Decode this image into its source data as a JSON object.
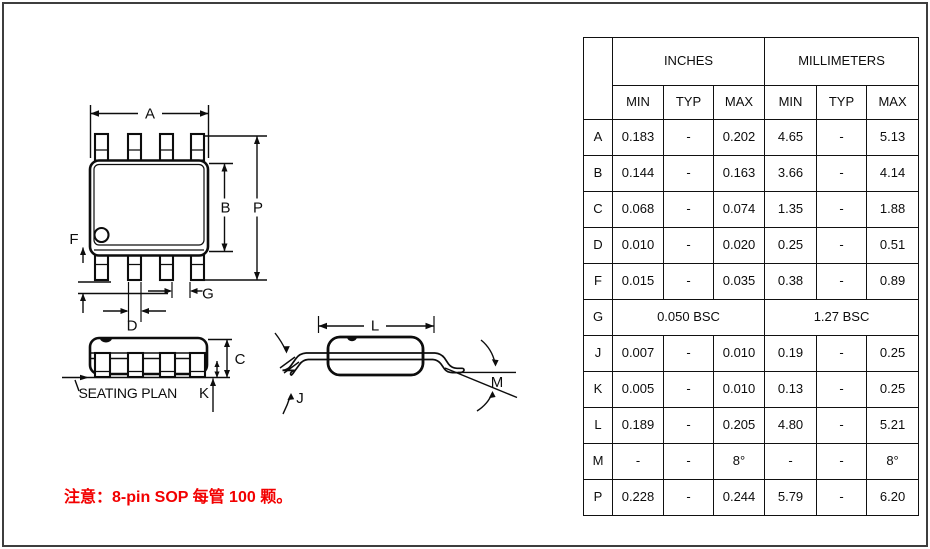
{
  "drawing": {
    "top_view": {
      "a": "A",
      "b": "B",
      "p": "P",
      "f": "F",
      "d": "D",
      "g": "G"
    },
    "side_view": {
      "c": "C",
      "k": "K",
      "seating": "SEATING PLAN"
    },
    "end_view": {
      "l": "L",
      "j": "J",
      "m": "M"
    }
  },
  "table": {
    "unit_headers": {
      "inches": "INCHES",
      "millimeters": "MILLIMETERS"
    },
    "col_headers": [
      "MIN",
      "TYP",
      "MAX",
      "MIN",
      "TYP",
      "MAX"
    ],
    "rows": [
      {
        "dim": "A",
        "cells": [
          "0.183",
          "-",
          "0.202",
          "4.65",
          "-",
          "5.13"
        ]
      },
      {
        "dim": "B",
        "cells": [
          "0.144",
          "-",
          "0.163",
          "3.66",
          "-",
          "4.14"
        ]
      },
      {
        "dim": "C",
        "cells": [
          "0.068",
          "-",
          "0.074",
          "1.35",
          "-",
          "1.88"
        ]
      },
      {
        "dim": "D",
        "cells": [
          "0.010",
          "-",
          "0.020",
          "0.25",
          "-",
          "0.51"
        ]
      },
      {
        "dim": "F",
        "cells": [
          "0.015",
          "-",
          "0.035",
          "0.38",
          "-",
          "0.89"
        ]
      },
      {
        "dim": "G",
        "span": true,
        "cells": [
          "0.050 BSC",
          "1.27 BSC"
        ]
      },
      {
        "dim": "J",
        "cells": [
          "0.007",
          "-",
          "0.010",
          "0.19",
          "-",
          "0.25"
        ]
      },
      {
        "dim": "K",
        "cells": [
          "0.005",
          "-",
          "0.010",
          "0.13",
          "-",
          "0.25"
        ]
      },
      {
        "dim": "L",
        "cells": [
          "0.189",
          "-",
          "0.205",
          "4.80",
          "-",
          "5.21"
        ]
      },
      {
        "dim": "M",
        "cells": [
          "-",
          "-",
          "8°",
          "-",
          "-",
          "8°"
        ]
      },
      {
        "dim": "P",
        "cells": [
          "0.228",
          "-",
          "0.244",
          "5.79",
          "-",
          "6.20"
        ]
      }
    ]
  },
  "note": {
    "text": "注意：8-pin SOP 每管 100 颗。"
  },
  "colors": {
    "line": "#0d0d0d",
    "page_border": "#3e3e3e",
    "note_red": "#f20000",
    "background": "#ffffff"
  }
}
